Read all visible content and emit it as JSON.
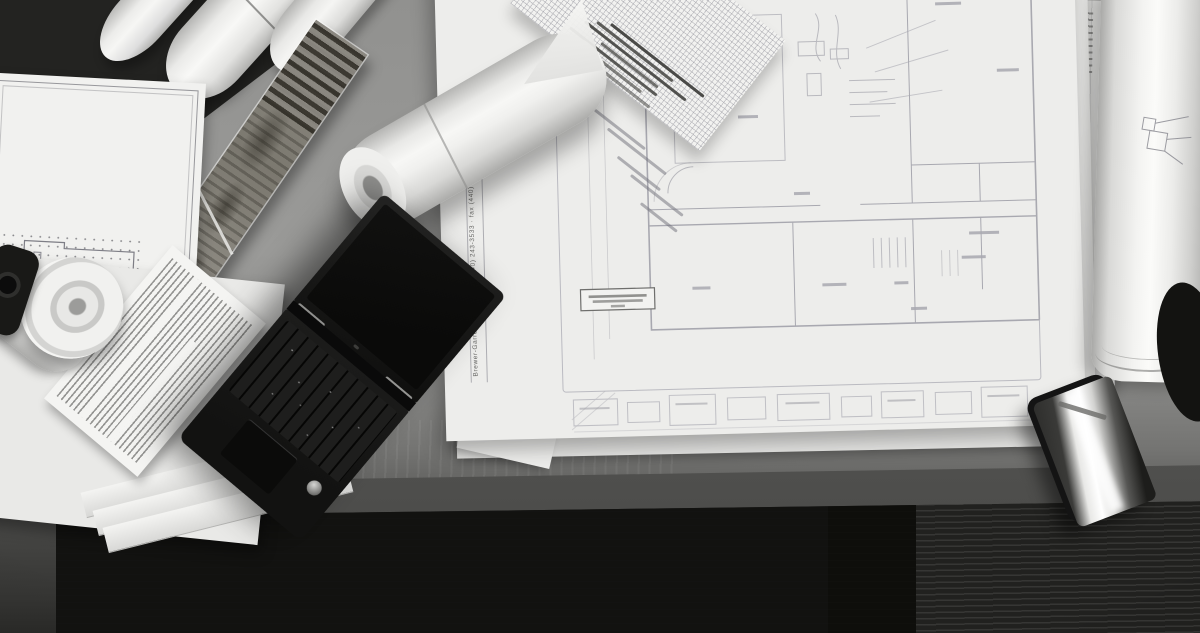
{
  "meta": {
    "kind": "black-and-white photograph",
    "description": "Overhead view of an architect's desk covered with a large blueprint floor plan, graph paper with handwritten notes, rolled drawings, an aged rolled site drawing, an open black laptop, stacked specification sheets, and a smartphone resting near the desk edge above dark carpet tiles."
  },
  "blueprint": {
    "edge_text": "Brewer-Garrett.com · phone (440) 243-3533 · fax (440)",
    "content_note": "floor plan with room partitions, piping annotations, a boxed general note and an elevation/schedule strip along the bottom edge (fine text illegible)"
  },
  "objects": {
    "laptop": {
      "label": "open black laptop, screen dark, keyboard catching light"
    },
    "smartphone": {
      "label": "black smartphone with bright window reflection on screen"
    },
    "graph_paper": {
      "label": "gridded graph paper with dark handwritten note lines"
    },
    "cone_roll": {
      "label": "large loosely rolled white drawing lying across the blueprint"
    },
    "top_left_rolls": {
      "label": "three rolled white drawing tubes"
    },
    "old_drawing_strip": {
      "label": "aged, darkened rolled drawing with title block and hatched end"
    },
    "small_blueprint": {
      "label": "small bordered plan sheet with dotted column grid"
    },
    "spec_sheet": {
      "label": "specification sheet with dense ruled text"
    },
    "paper_stack": {
      "label": "stack of flat sheets with fanned corners"
    },
    "curled_roll": {
      "label": "spiral end of a curled paper roll"
    },
    "right_roll": {
      "label": "tall rolled sheet with small detail sketch"
    },
    "desk": {
      "label": "wood desk surface with front edge"
    },
    "floor": {
      "label": "dark carpet tiles with striped right tile"
    }
  },
  "palette": {
    "paper": "#efefed",
    "ink_line": "#9d9da6",
    "desk_light": "#9a9a98",
    "desk_edge": "#4c4c4a",
    "floor_dark": "#141412",
    "laptop_black": "#151514",
    "reflection_white": "#ffffff"
  }
}
